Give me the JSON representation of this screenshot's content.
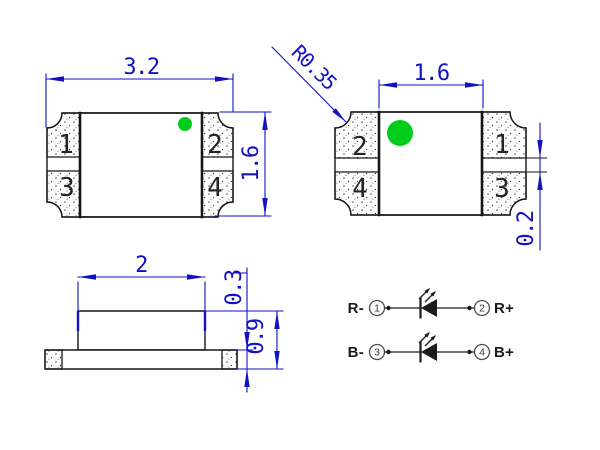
{
  "drawing_title": "SMD LED package outline drawing",
  "colors": {
    "dimension_blue": "#1212c4",
    "marker_green": "#00cc1c",
    "geometry_black": "#161616"
  },
  "top_view": {
    "width_dim": "3.2",
    "height_dim": "1.6",
    "pads": [
      "1",
      "2",
      "3",
      "4"
    ]
  },
  "bottom_view": {
    "width_dim": "1.6",
    "radius_dim": "R0.35",
    "gap_dim": "0.2",
    "pads": [
      "2",
      "1",
      "4",
      "3"
    ]
  },
  "side_view": {
    "width_dim": "2",
    "base_dim": "0.3",
    "height_dim": "0.9"
  },
  "schematic": {
    "rows": [
      {
        "neg_label": "R-",
        "neg_pin": "1",
        "pos_pin": "2",
        "pos_label": "R+"
      },
      {
        "neg_label": "B-",
        "neg_pin": "3",
        "pos_pin": "4",
        "pos_label": "B+"
      }
    ]
  }
}
